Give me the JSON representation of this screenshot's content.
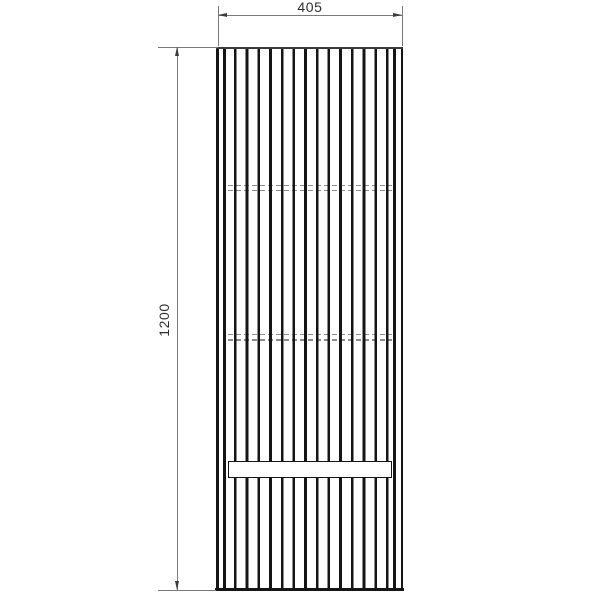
{
  "figure": {
    "type": "technical-drawing",
    "subject": "tall-slatted-cabinet-front-view"
  },
  "dims": {
    "width_label": "405",
    "height_label": "1200"
  },
  "drawing": {
    "slat_count": 14,
    "hidden_shelf_line_pairs": 2,
    "recess_band_count": 1
  },
  "colors": {
    "background": "#ffffff",
    "outline": "#151515",
    "edge": "#3a3a3a",
    "dimension_line": "#7a7a7a",
    "dimension_text": "#2f2f2f",
    "hidden_line": "#8c8c8c"
  }
}
